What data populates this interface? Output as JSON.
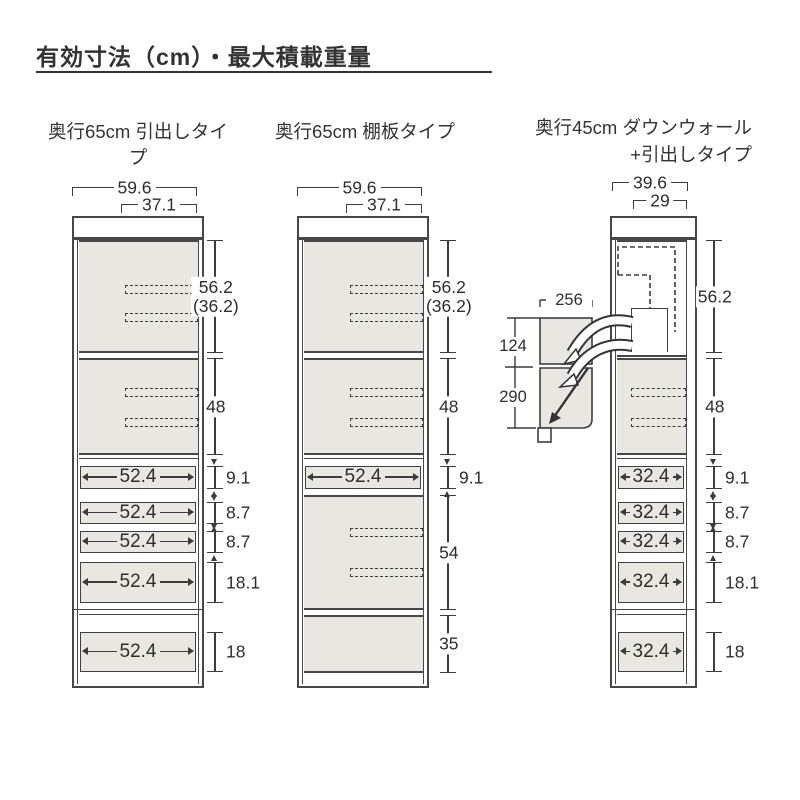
{
  "title": "有効寸法（cm）・最大積載重量",
  "colors": {
    "section_fill": "#e9e7e2",
    "line_color": "#3c3c3c",
    "border_color": "#474747"
  },
  "cabinets": [
    {
      "header": "奥行65cm 引出しタイプ",
      "outer_width": "59.6",
      "inner_width": "37.1",
      "right_dims": [
        {
          "v": "56.2",
          "v2": "(36.2)"
        },
        {
          "v": "48"
        },
        {
          "v": "9.1"
        },
        {
          "v": "8.7"
        },
        {
          "v": "8.7"
        },
        {
          "v": "18.1"
        },
        {
          "v": "18"
        }
      ],
      "drawers": [
        {
          "label": "52.4"
        },
        {
          "label": "52.4"
        },
        {
          "label": "52.4"
        },
        {
          "label": "52.4"
        },
        {
          "label": "52.4"
        }
      ]
    },
    {
      "header": "奥行65cm 棚板タイプ",
      "outer_width": "59.6",
      "inner_width": "37.1",
      "right_dims": [
        {
          "v": "56.2",
          "v2": "(36.2)"
        },
        {
          "v": "48"
        },
        {
          "v": "9.1"
        },
        {
          "v": "54"
        },
        {
          "v": "35"
        }
      ],
      "drawers": [
        {
          "label": "52.4"
        }
      ]
    },
    {
      "header": "奥行45cm ダウンウォール",
      "header2": "+引出しタイプ",
      "outer_width": "39.6",
      "inner_width": "29",
      "right_dims": [
        {
          "v": "56.2"
        },
        {
          "v": "48"
        },
        {
          "v": "9.1"
        },
        {
          "v": "8.7"
        },
        {
          "v": "8.7"
        },
        {
          "v": "18.1"
        },
        {
          "v": "18"
        }
      ],
      "drawers": [
        {
          "label": "32.4"
        },
        {
          "label": "32.4"
        },
        {
          "label": "32.4"
        },
        {
          "label": "32.4"
        },
        {
          "label": "32.4"
        }
      ],
      "side_view": {
        "width_mm": "256",
        "upper_mm": "124",
        "lower_mm": "290"
      }
    }
  ]
}
